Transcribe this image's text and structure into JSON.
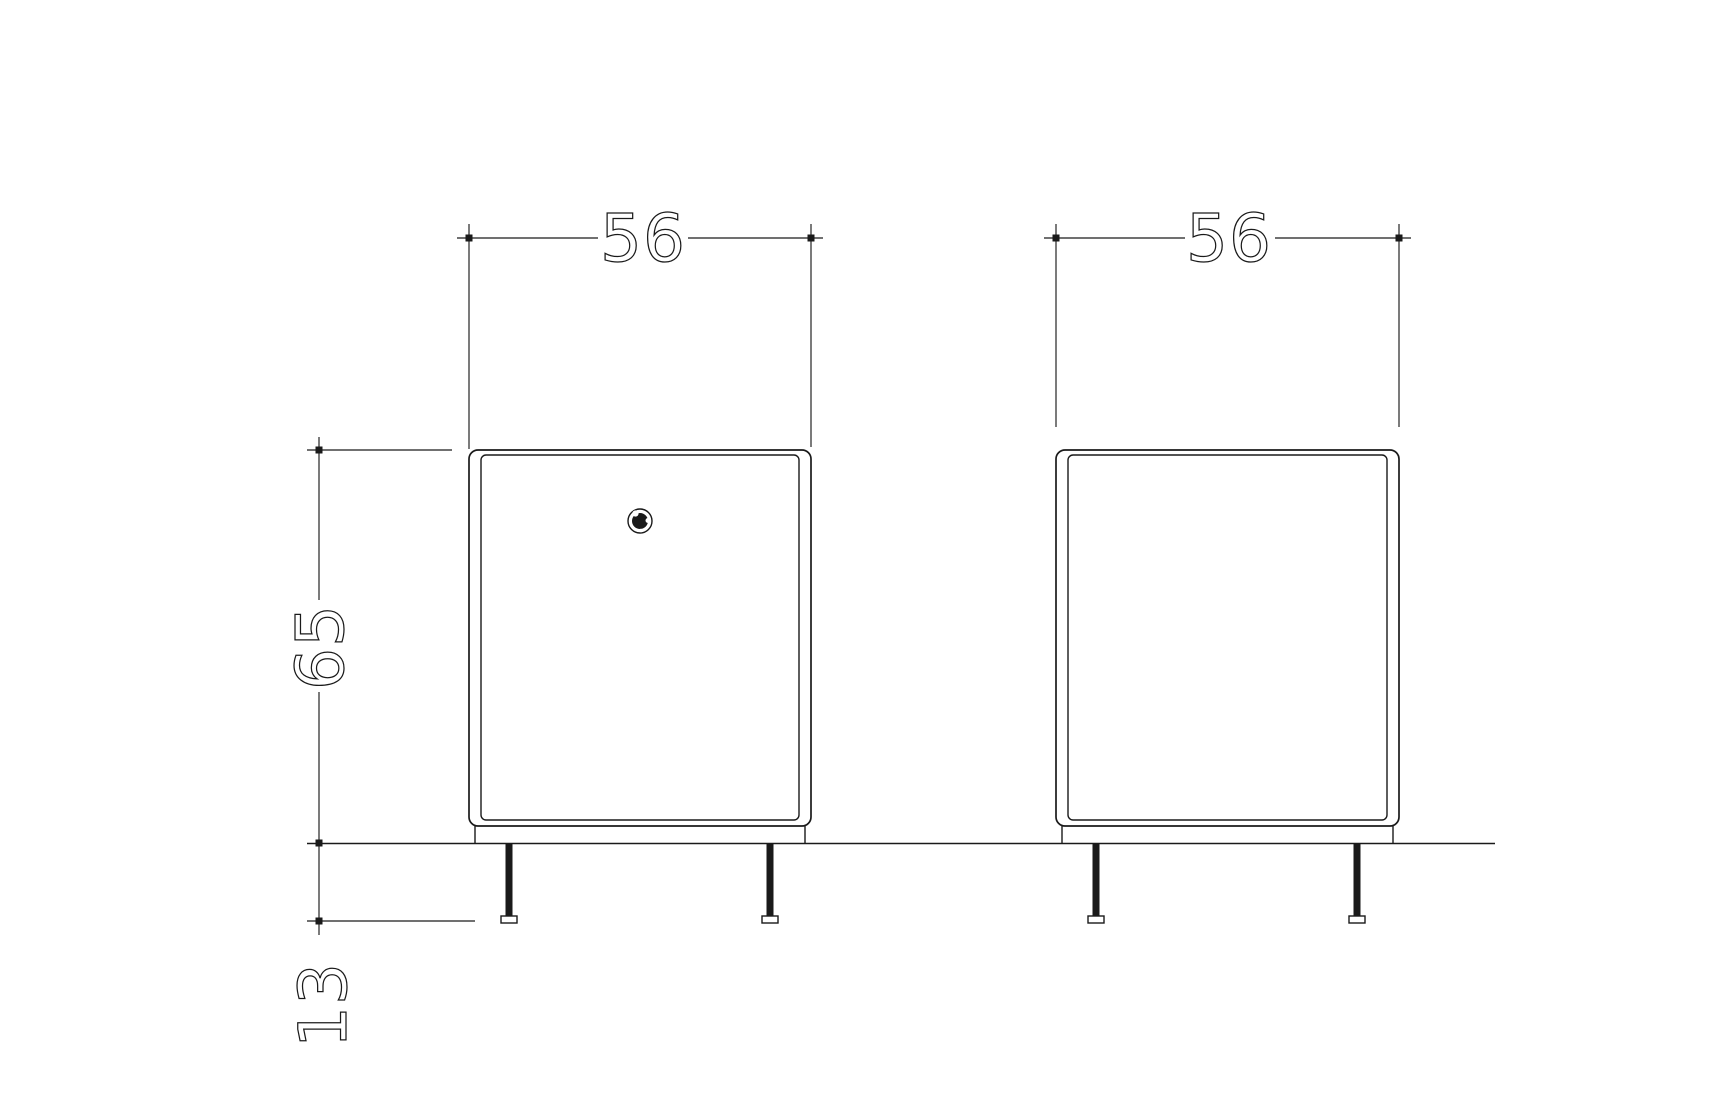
{
  "drawing": {
    "background_color": "#ffffff",
    "line_color": "#1a1a1a",
    "annotations": {
      "left_width": "56",
      "right_width": "56",
      "height": "65",
      "leg_height": "13"
    },
    "icons": {
      "knob": "lock-knob-icon"
    }
  }
}
